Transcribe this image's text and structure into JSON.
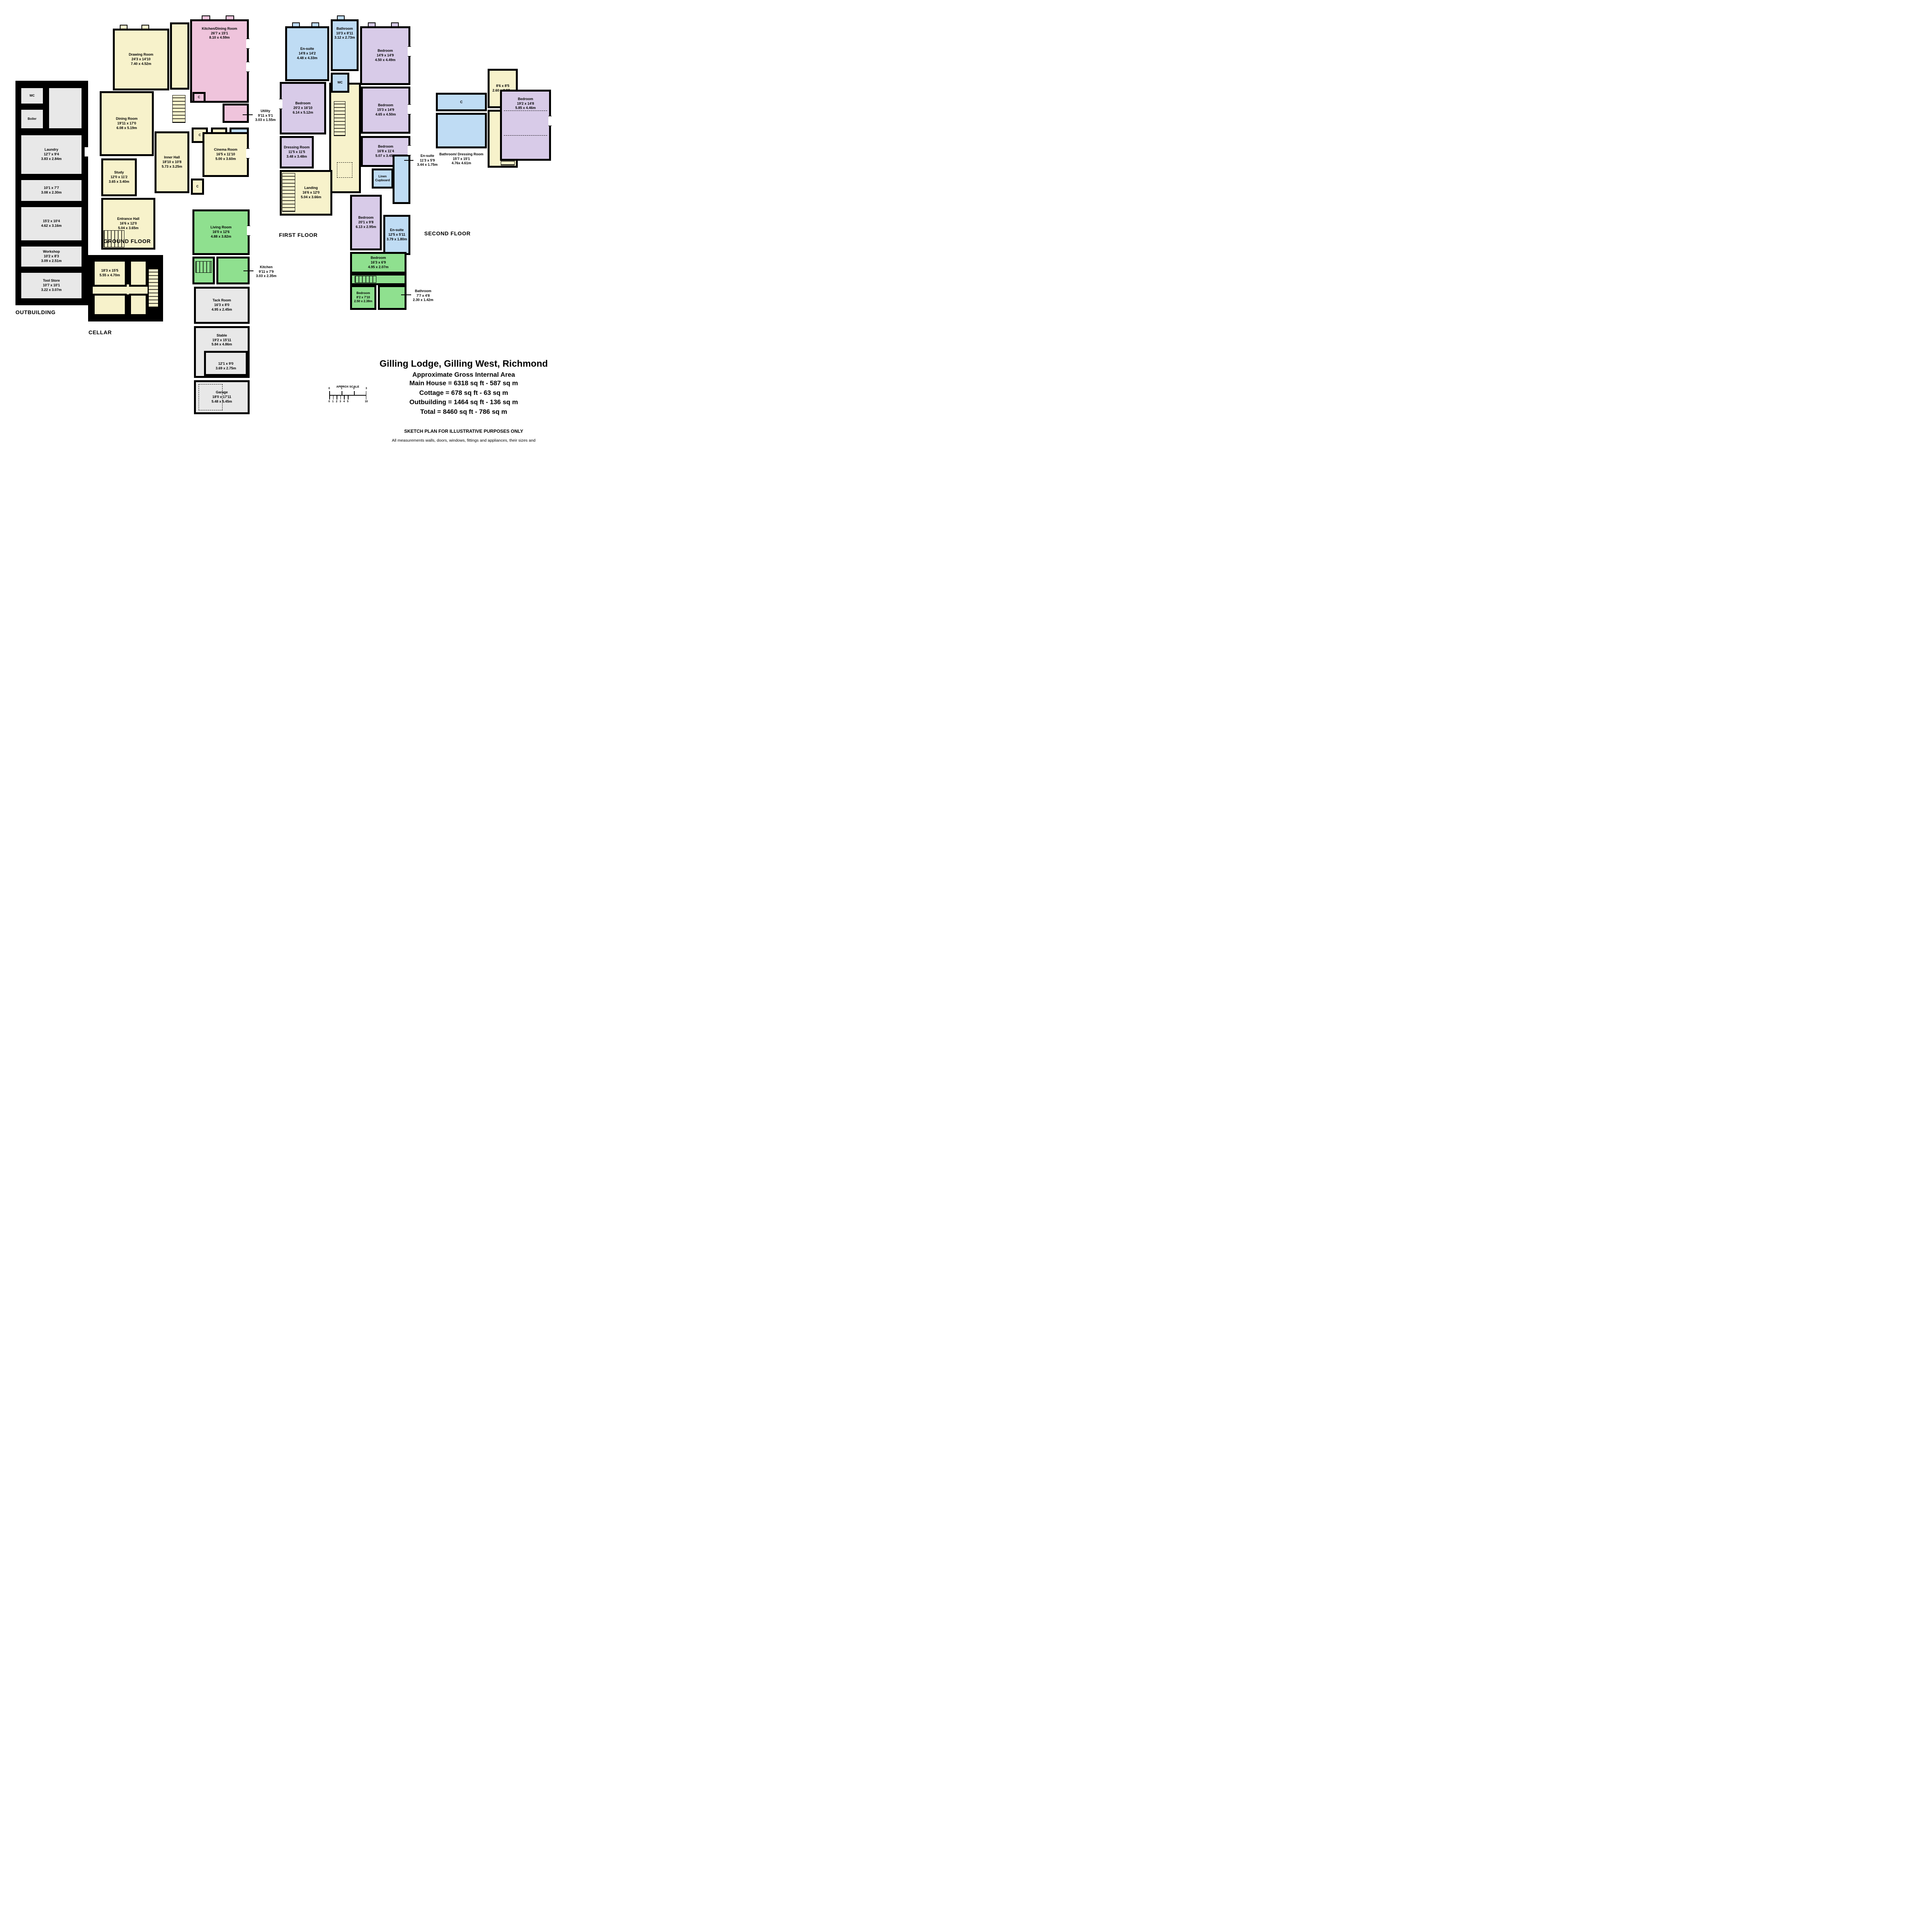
{
  "palette": {
    "cream": "#F7F2CB",
    "pink": "#EFC4DC",
    "purple": "#D8CBE8",
    "blue": "#BFDCF4",
    "green": "#8FE08F",
    "grey": "#E8E8E8",
    "wall": "#000000"
  },
  "floors": {
    "ground": {
      "label": "GROUND FLOOR",
      "rooms": {
        "drawing": {
          "name": "Drawing Room",
          "ft": "24'3 x 14'10",
          "m": "7.40 x 4.52m"
        },
        "kitchen_dining": {
          "name": "Kitchen/Dining Room",
          "ft": "26'7 x 15'1",
          "m": "8.10 x 4.59m"
        },
        "dining": {
          "name": "Dining Room",
          "ft": "19'11 x 17'0",
          "m": "6.08 x 5.19m"
        },
        "utility": {
          "name": "Utility",
          "ft": "9'11 x 5'1",
          "m": "3.03 x 1.55m"
        },
        "wc": {
          "name": "WC"
        },
        "c1": {
          "name": "C"
        },
        "c2": {
          "name": "C"
        },
        "c3": {
          "name": "C"
        },
        "c4": {
          "name": "C"
        },
        "study": {
          "name": "Study",
          "ft": "12'0 x 11'2",
          "m": "3.65 x 3.40m"
        },
        "inner_hall": {
          "name": "Inner Hall",
          "ft": "18'10 x 10'8",
          "m": "5.73 x 3.25m"
        },
        "cinema": {
          "name": "Cinema Room",
          "ft": "16'5 x 11'10",
          "m": "5.00 x 3.60m"
        },
        "entrance": {
          "name": "Entrance Hall",
          "ft": "16'6 x 12'0",
          "m": "5.04 x 3.65m"
        },
        "living": {
          "name": "Living Room",
          "ft": "16'0 x 12'6",
          "m": "4.88 x 3.82m"
        },
        "kitchen": {
          "name": "Kitchen",
          "ft": "9'11 x 7'9",
          "m": "3.03 x 2.35m"
        },
        "tack": {
          "name": "Tack Room",
          "ft": "16'3 x 8'0",
          "m": "4.95 x 2.45m"
        },
        "stable": {
          "name": "Stable",
          "ft": "19'2 x 15'11",
          "m": "5.84 x 4.86m"
        },
        "room12": {
          "ft": "12'1 x 9'0",
          "m": "3.69 x 2.75m"
        },
        "garage": {
          "name": "Garage",
          "ft": "18'0 x 17'11",
          "m": "5.48 x 5.45m"
        }
      }
    },
    "first": {
      "label": "FIRST FLOOR",
      "rooms": {
        "ensuite1": {
          "name": "En-suite",
          "ft": "14'8 x 14'2",
          "m": "4.48 x 4.33m"
        },
        "bathroom1": {
          "name": "Bathroom",
          "ft": "10'3 x 8'11",
          "m": "3.12 x 2.73m"
        },
        "wc": {
          "name": "WC"
        },
        "bed1": {
          "name": "Bedroom",
          "ft": "14'9 x 14'9",
          "m": "4.50 x 4.49m"
        },
        "bed2": {
          "name": "Bedroom",
          "ft": "20'2 x 16'10",
          "m": "6.14 x 5.12m"
        },
        "bed3": {
          "name": "Bedroom",
          "ft": "15'3 x 14'9",
          "m": "4.65 x 4.50m"
        },
        "bed4": {
          "name": "Bedroom",
          "ft": "16'8 x 11'4",
          "m": "5.07 x 3.45m"
        },
        "dressing": {
          "name": "Dressing Room",
          "ft": "11'5 x 11'5",
          "m": "3.48 x 3.48m"
        },
        "landing": {
          "name": "Landing",
          "ft": "16'6 x 12'0",
          "m": "5.04 x 3.66m"
        },
        "linen": {
          "name": "Linen Cupboard"
        },
        "ensuite2": {
          "name": "En-suite",
          "ft": "11'3 x 5'9",
          "m": "3.44 x 1.75m"
        },
        "bed5": {
          "name": "Bedroom",
          "ft": "20'1 x 9'8",
          "m": "6.13 x 2.95m"
        },
        "ensuite3": {
          "name": "En-suite",
          "ft": "12'5 x 5'11",
          "m": "3.79 x 1.80m"
        },
        "bed6": {
          "name": "Bedroom",
          "ft": "16'3 x 6'9",
          "m": "4.95 x 2.07m"
        },
        "bed7": {
          "name": "Bedroom",
          "ft": "8'2 x 7'10",
          "m": "2.50 x 2.38m"
        },
        "bathroom2": {
          "name": "Bathroom",
          "ft": "7'7 x 4'8",
          "m": "2.30 x 1.42m"
        }
      }
    },
    "second": {
      "label": "SECOND FLOOR",
      "rooms": {
        "room86": {
          "ft": "8'6 x 8'5",
          "m": "2.60 x 2.57m"
        },
        "c": {
          "name": "C"
        },
        "bathdress": {
          "name": "Bathroom/ Dressing Room",
          "ft": "15'7 x 15'1",
          "m": "4.76x 4.61m"
        },
        "bed": {
          "name": "Bedroom",
          "ft": "19'2 x 14'8",
          "m": "5.85 x 4.46m"
        }
      }
    },
    "cellar": {
      "label": "CELLAR",
      "rooms": {
        "main": {
          "ft": "18'3 x 15'5",
          "m": "5.55 x 4.70m"
        }
      }
    },
    "outbuilding": {
      "label": "OUTBUILDING",
      "rooms": {
        "wc": {
          "name": "WC"
        },
        "boiler": {
          "name": "Boiler"
        },
        "laundry": {
          "name": "Laundry",
          "ft": "12'7 x 9'4",
          "m": "3.83 x 2.84m"
        },
        "room101": {
          "ft": "10'1 x 7'7",
          "m": "3.08 x 2.30m"
        },
        "room152": {
          "ft": "15'2 x 10'4",
          "m": "4.62 x 3.16m"
        },
        "workshop": {
          "name": "Workshop",
          "ft": "10'2 x 8'3",
          "m": "3.09 x 2.51m"
        },
        "toolstore": {
          "name": "Tool Store",
          "ft": "10'7 x 10'1",
          "m": "3.22 x 3.07m"
        }
      }
    }
  },
  "title_block": {
    "title": "Gilling Lodge, Gilling West, Richmond",
    "subtitle": "Approximate Gross Internal Area",
    "line1": "Main House = 6318 sq ft - 587 sq m",
    "line2": "Cottage = 678 sq ft - 63 sq m",
    "line3": "Outbuilding = 1464 sq ft - 136 sq m",
    "line4": "Total = 8460 sq ft - 786 sq m",
    "sketch": "SKETCH PLAN FOR ILLUSTRATIVE PURPOSES ONLY",
    "disclaimer": "All measurements walls, doors, windows, fittings and appliances, their sizes and locations, are approximate only. They cannot be regarded as being a representation by the seller, nor their agent.",
    "produced": "Produced by Potterplans Ltd. 2020"
  },
  "scale_bar": {
    "label": "APPROX SCALE",
    "top_ticks": [
      "0",
      "1",
      "2",
      "3"
    ],
    "bottom_ticks": [
      "0",
      "1",
      "2",
      "3",
      "4",
      "5",
      "10"
    ]
  }
}
